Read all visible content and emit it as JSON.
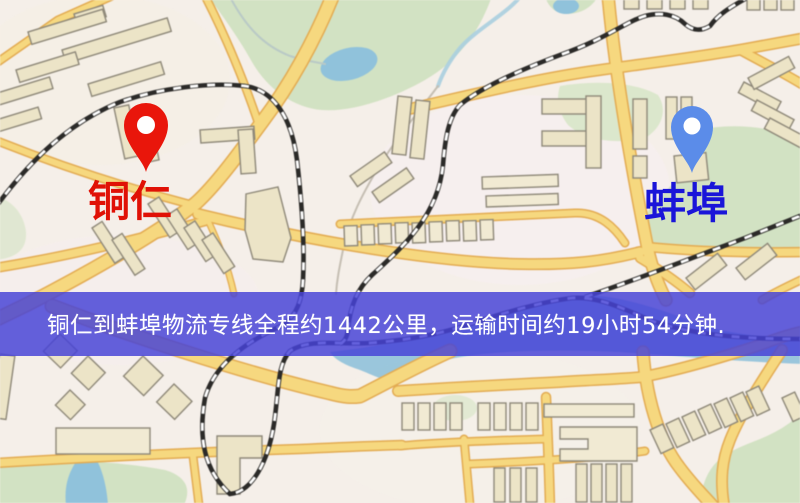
{
  "banner": {
    "text": "铜仁到蚌埠物流专线全程约1442公里，运输时间约19小时54分钟.",
    "bg": "rgba(70,67,214,0.84)",
    "fg": "#ffffff"
  },
  "route": {
    "origin": "铜仁",
    "destination": "蚌埠",
    "distance_text": "约1442公里",
    "duration_text": "约19小时54分钟"
  },
  "markers": [
    {
      "name": "铜仁",
      "pin_color": "#e9160b",
      "label_color": "#e01106"
    },
    {
      "name": "蚌埠",
      "pin_color": "#5b8ce9",
      "label_color": "#1a15d9"
    }
  ],
  "map_palette": {
    "background": "#f5efe9",
    "road": "#f7d87c",
    "road_casing": "#e4ab4f",
    "building": "#ece4c6",
    "building_outline": "#8e8878",
    "green": "#d2e2c2",
    "water": "#8fc2dc",
    "railway": "#2b2a28"
  }
}
